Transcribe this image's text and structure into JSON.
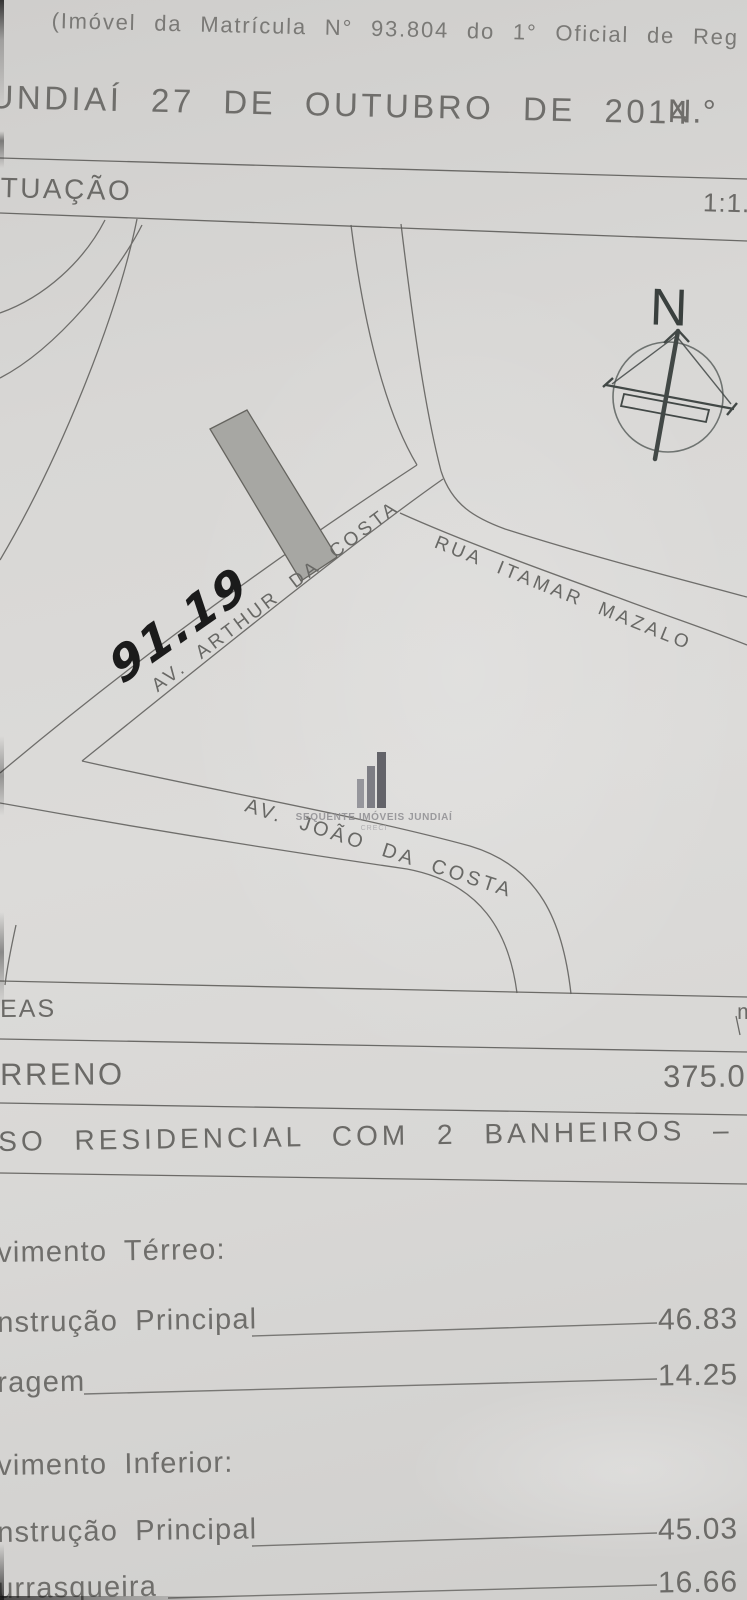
{
  "document": {
    "header": {
      "matricula_line": "(Imóvel da Matrícula N° 93.804 do 1° Oficial de Reg",
      "date_line": "UNDIAÍ 27 DE OUTUBRO DE 2014",
      "number_label": "N.°"
    },
    "situacao": {
      "title_fragment": "TUAÇÃO",
      "scale_fragment": "1:1.0"
    },
    "map": {
      "handwritten_value": "91.19",
      "compass_label": "N",
      "streets": [
        {
          "label": "AV. ARTHUR DA COSTA"
        },
        {
          "label": "RUA ITAMAR MAZALO"
        },
        {
          "label": "AV. JOÃO DA COSTA"
        }
      ],
      "watermark": {
        "brand": "SEQUENTE IMÓVEIS JUNDIAÍ",
        "sub": "CRECI"
      },
      "lot_fill_color": "#a7a7a3",
      "line_color": "#605f5c"
    },
    "areas": {
      "section_fragment": "EAS",
      "unit_fragment": "m",
      "terreno": {
        "label": "RRENO",
        "value": "375.0"
      },
      "uso": {
        "label": "SO RESIDENCIAL COM 2 BANHEIROS – 1 UN"
      },
      "pavimento_terreo": {
        "title": "vimento Térreo:",
        "rows": [
          {
            "label": "nstrução Principal",
            "value": "46.83"
          },
          {
            "label": "ragem",
            "value": "14.25"
          }
        ]
      },
      "pavimento_inferior": {
        "title": "vimento Inferior:",
        "rows": [
          {
            "label": "nstrução Principal",
            "value": "45.03"
          },
          {
            "label": "urrasqueira",
            "value": "16.66"
          }
        ]
      }
    }
  }
}
